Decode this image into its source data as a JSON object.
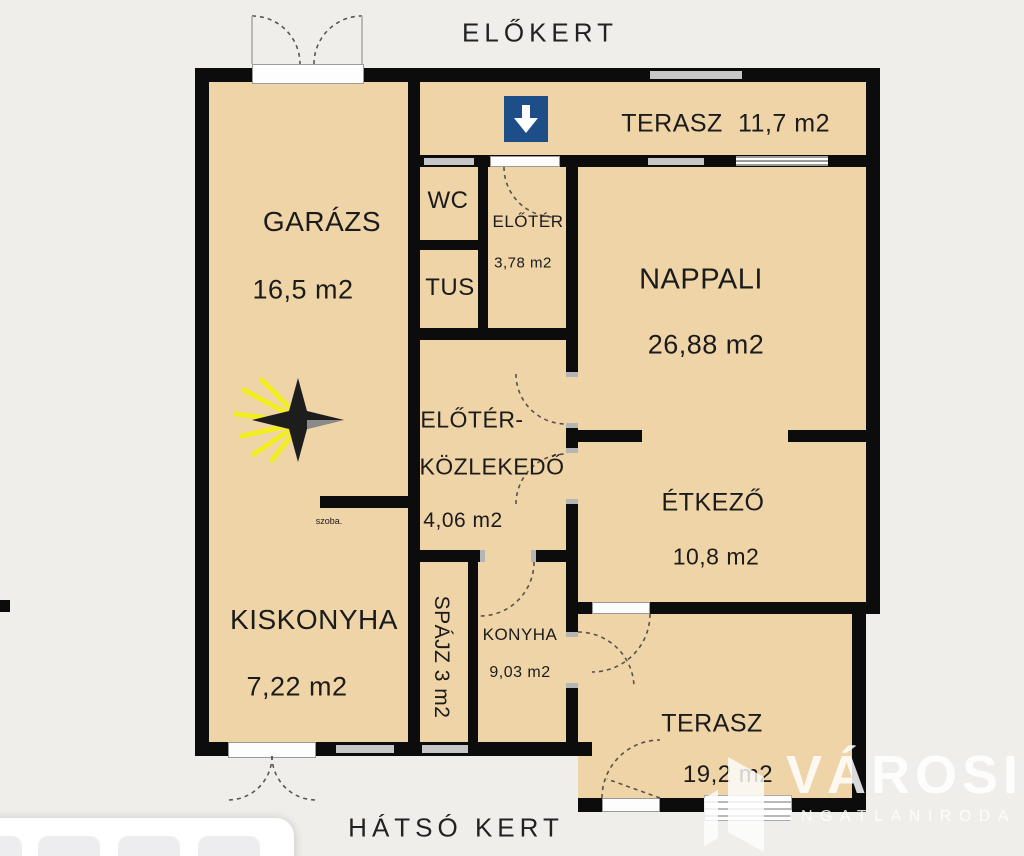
{
  "labels": {
    "front_garden": "ELŐKERT",
    "back_garden": "HÁTSÓ KERT",
    "small_note": "szoba."
  },
  "rooms": {
    "terasz_top": {
      "name": "TERASZ",
      "area": "11,7 m2"
    },
    "garazs": {
      "name": "GARÁZS",
      "area": "16,5 m2"
    },
    "wc": {
      "name": "WC"
    },
    "tus": {
      "name": "TUS"
    },
    "eloter": {
      "name": "ELŐTÉR",
      "area": "3,78 m2"
    },
    "nappali": {
      "name": "NAPPALI",
      "area": "26,88 m2"
    },
    "kozlekedo": {
      "line1": "ELŐTÉR-",
      "line2": "KÖZLEKEDŐ",
      "area": "4,06 m2"
    },
    "etkezo": {
      "name": "ÉTKEZŐ",
      "area": "10,8 m2"
    },
    "kiskonyha": {
      "name": "KISKONYHA",
      "area": "7,22 m2"
    },
    "spajz": {
      "name": "SPÁJZ 3 m2"
    },
    "konyha": {
      "name": "KONYHA",
      "area": "9,03 m2"
    },
    "terasz_bottom": {
      "name": "TERASZ",
      "area": "19,2 m2"
    }
  },
  "watermark": {
    "brand": "VÁROSI",
    "subtitle": "INGATLANIRODA"
  },
  "icons": {
    "entrance": "down-arrow",
    "orientation": "compass-star"
  },
  "colors": {
    "floor": "#eed4a6",
    "wall": "#0c0c0c",
    "background": "#efeeea",
    "entrance_blue": "#1d4e87",
    "compass_yellow": "#f2ee1f"
  }
}
